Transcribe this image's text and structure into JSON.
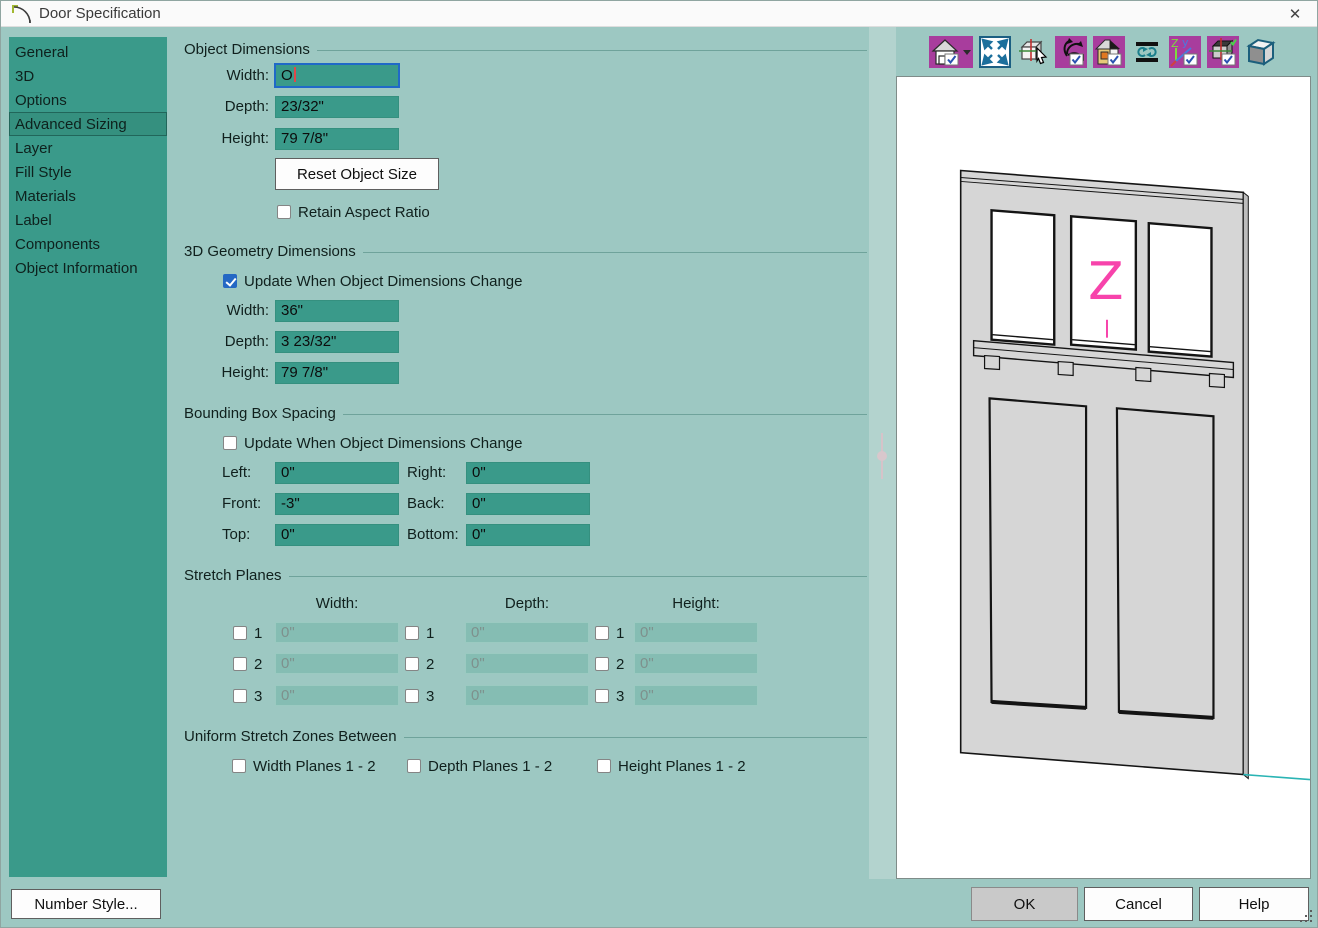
{
  "window": {
    "title": "Door Specification",
    "close_glyph": "✕"
  },
  "sidebar": {
    "items": [
      {
        "label": "General",
        "selected": false
      },
      {
        "label": "3D",
        "selected": false
      },
      {
        "label": "Options",
        "selected": false
      },
      {
        "label": "Advanced Sizing",
        "selected": true
      },
      {
        "label": "Layer",
        "selected": false
      },
      {
        "label": "Fill Style",
        "selected": false
      },
      {
        "label": "Materials",
        "selected": false
      },
      {
        "label": "Label",
        "selected": false
      },
      {
        "label": "Components",
        "selected": false
      },
      {
        "label": "Object Information",
        "selected": false
      }
    ]
  },
  "sections": {
    "object_dimensions": {
      "title": "Object Dimensions",
      "rows": [
        {
          "label": "Width:",
          "value": "O",
          "focused": true
        },
        {
          "label": "Depth:",
          "value": "23/32\""
        },
        {
          "label": "Height:",
          "value": "79 7/8\""
        }
      ],
      "reset_button": "Reset Object Size",
      "retain_aspect": {
        "label": "Retain Aspect Ratio",
        "checked": false
      }
    },
    "geometry": {
      "title": "3D Geometry Dimensions",
      "update": {
        "label": "Update When Object Dimensions Change",
        "checked": true
      },
      "rows": [
        {
          "label": "Width:",
          "value": "36\""
        },
        {
          "label": "Depth:",
          "value": "3 23/32\""
        },
        {
          "label": "Height:",
          "value": "79 7/8\""
        }
      ]
    },
    "bounding": {
      "title": "Bounding Box Spacing",
      "update": {
        "label": "Update When Object Dimensions Change",
        "checked": false
      },
      "rows": [
        {
          "l1": "Left:",
          "v1": "0\"",
          "l2": "Right:",
          "v2": "0\""
        },
        {
          "l1": "Front:",
          "v1": "-3\"",
          "l2": "Back:",
          "v2": "0\""
        },
        {
          "l1": "Top:",
          "v1": "0\"",
          "l2": "Bottom:",
          "v2": "0\""
        }
      ]
    },
    "stretch": {
      "title": "Stretch Planes",
      "columns": [
        "Width:",
        "Depth:",
        "Height:"
      ],
      "row_labels": [
        "1",
        "2",
        "3"
      ],
      "placeholder": "0\"",
      "checked": false
    },
    "uniform": {
      "title": "Uniform Stretch Zones Between",
      "options": [
        {
          "label": "Width Planes 1 - 2",
          "checked": false
        },
        {
          "label": "Depth Planes 1 - 2",
          "checked": false
        },
        {
          "label": "Height Planes 1 - 2",
          "checked": false
        }
      ]
    }
  },
  "preview": {
    "toolbar_icons": [
      "standard-views",
      "fill-window",
      "tilt-box-pointer",
      "mouse-orbit",
      "perspective-view",
      "spin-view",
      "show-axes",
      "bounding-box",
      "cube-3d"
    ],
    "door_label": "Z"
  },
  "footer": {
    "number_style": "Number Style...",
    "ok": "OK",
    "cancel": "Cancel",
    "help": "Help"
  },
  "colors": {
    "dialog_bg": "#9dc8c2",
    "panel_teal": "#3a9a8a",
    "selected_item": "#35907f",
    "focus_blue": "#2069c8",
    "check_blue": "#2468c4",
    "toolbar_magenta": "#a83d9d",
    "door_label_pink": "#f743ab",
    "preview_line_teal": "#2ab4b4"
  }
}
